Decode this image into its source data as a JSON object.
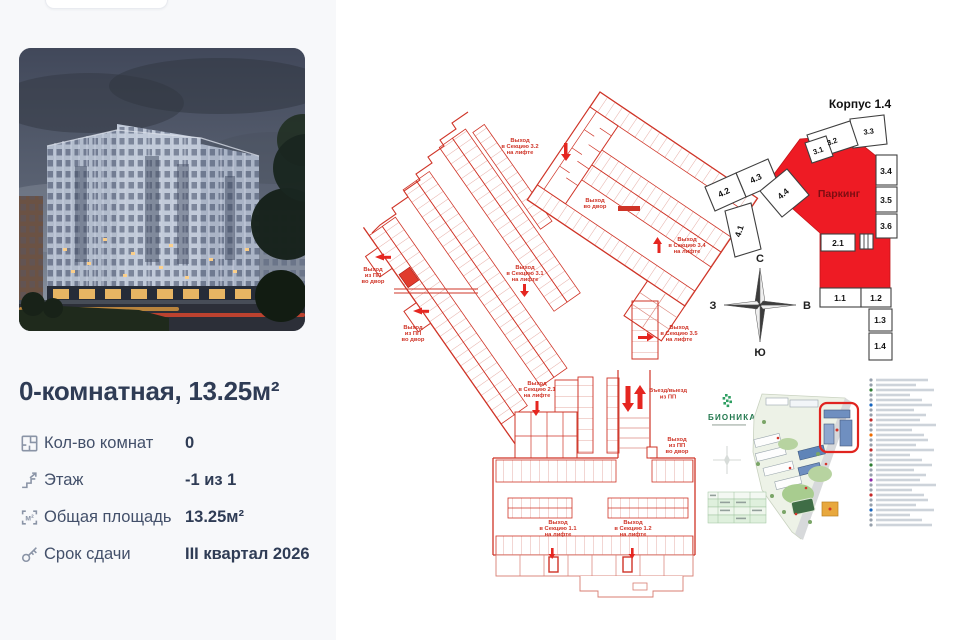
{
  "listing": {
    "title": "0-комнатная, 13.25м²",
    "specs": [
      {
        "label": "Кол-во комнат",
        "value": "0"
      },
      {
        "label": "Этаж",
        "value": "-1 из 1"
      },
      {
        "label": "Общая площадь",
        "value": "13.25м²"
      },
      {
        "label": "Срок сдачи",
        "value": "III квартал 2026"
      }
    ],
    "area_icon_glyph": "м²"
  },
  "floor_plan": {
    "labels": {
      "exit_3_2": [
        "Выход",
        "в Секцию 3.2",
        "на лифте"
      ],
      "exit_3_1": [
        "Выход",
        "в Секцию 3.1",
        "на лифте"
      ],
      "exit_3_4": [
        "Выход",
        "в Секцию 3.4",
        "на лифте"
      ],
      "exit_3_5": [
        "Выход",
        "в Секцию 3.5",
        "на лифте"
      ],
      "exit_2_1": [
        "Выход",
        "в Секцию 2.1",
        "на лифте"
      ],
      "exit_1_1": [
        "Выход",
        "в Секцию 1.1",
        "на лифте"
      ],
      "exit_1_2": [
        "Выход",
        "в Секцию 1.2",
        "на лифте"
      ],
      "yard_exit_1": [
        "Выход",
        "из ПП",
        "во двор"
      ],
      "yard_exit_2": [
        "Выход",
        "из ПП",
        "во двор"
      ],
      "yard_exit_3": [
        "Выход",
        "из ПП",
        "во двор"
      ],
      "yard_exit_small": [
        "Выход",
        "во двор"
      ],
      "ramp": [
        "Въезд/выезд",
        "из ПП"
      ]
    }
  },
  "scheme": {
    "title": "Корпус 1.4",
    "parking_label": "Паркинг",
    "sections": [
      "3.2",
      "3.3",
      "3.1",
      "3.4",
      "3.5",
      "3.6",
      "4.3",
      "4.2",
      "4.4",
      "4.1",
      "2.1",
      "1.1",
      "1.2",
      "1.3",
      "1.4"
    ],
    "compass": {
      "n": "С",
      "e": "В",
      "s": "Ю",
      "w": "З"
    }
  },
  "sitemap": {
    "logo": "БИОНИКА",
    "legend_rows": 30
  },
  "colors": {
    "plan_red": "#cf3427",
    "plan_red_light": "#dc8b81",
    "accent_red": "#e52620",
    "scheme_red": "#ee1b24",
    "text_dark": "#2f3c55",
    "panel_bg": "#f7f8fa"
  }
}
